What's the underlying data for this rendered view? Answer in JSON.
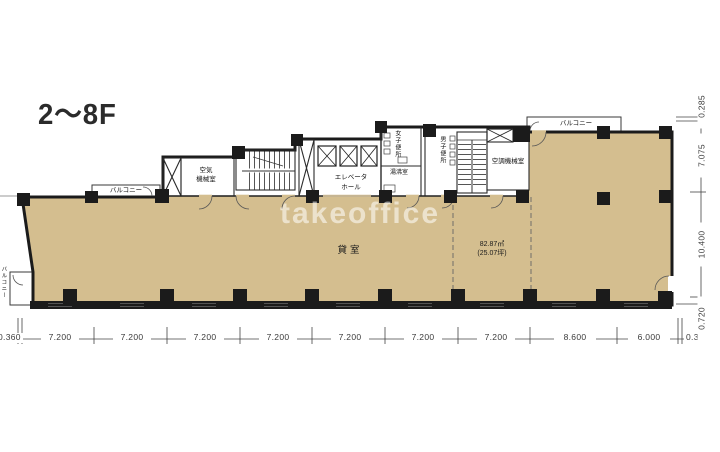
{
  "title": "2〜8F",
  "watermark": "takeoffice",
  "rooms": {
    "rental": "貸室",
    "rental_area_m2": "82.87㎡",
    "rental_area_tsubo": "(25.07坪)",
    "air_machine_line1": "空気",
    "air_machine_line2": "機械室",
    "elevator_hall_line1": "エレベータ",
    "elevator_hall_line2": "ホール",
    "womens_toilet": "女子便所",
    "mens_toilet": "男子便所",
    "hot_water": "湯沸室",
    "hvac_machine": "空調機械室",
    "balcony_top_left": "バルコニー",
    "balcony_top_right": "バルコニー",
    "balcony_bottom_left": "バルコニー"
  },
  "dimensions": {
    "bottom": [
      "0.360",
      "7.200",
      "7.200",
      "7.200",
      "7.200",
      "7.200",
      "7.200",
      "7.200",
      "8.600",
      "6.000",
      "0.360"
    ],
    "right": [
      "0.285",
      "7.075",
      "10.400",
      "0.720"
    ]
  },
  "colors": {
    "floor": "#d4be8f",
    "wall": "#1b1b1b"
  }
}
